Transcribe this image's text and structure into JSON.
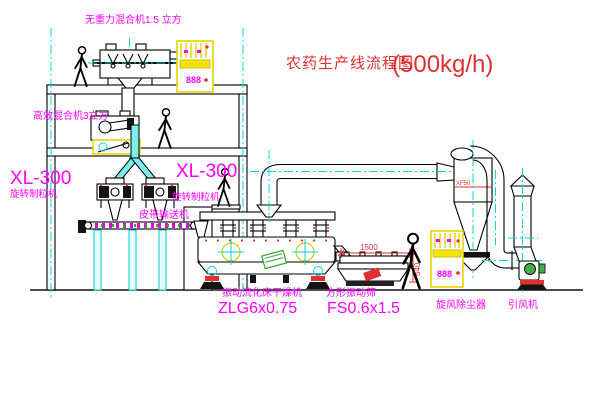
{
  "title": {
    "name": "农药生产线流程图",
    "capacity": "(500kg/h)"
  },
  "labels": {
    "gravity_mixer": "无重力混合机1.5 立方",
    "high_eff_mixer": "高效混合机3立方",
    "granulator1_model": "XL-300",
    "granulator1_name": "旋转制粒机",
    "granulator2_model": "XL-300",
    "granulator2_name": "旋转制粒机",
    "belt_conveyor": "皮带输送机",
    "fluid_bed_dryer": "振动流化床干燥机",
    "fluid_bed_dryer_model": "ZLG6x0.75",
    "square_sieve": "方形振动筛",
    "square_sieve_model": "FS0.6x1.5",
    "cyclone": "旋风除尘器",
    "fan": "引风机"
  },
  "annotations": {
    "cyclone_tag": "XF50",
    "sieve_width_dim": "1500",
    "sieve_height_dim": "540",
    "cabinet1_display": "888",
    "cabinet2_display": "888"
  },
  "colors": {
    "outline": "#000000",
    "centerline": "#00d8d8",
    "label": "#ff00ff",
    "title": "#e03030",
    "cabinet": "#f2e400",
    "dimension": "#e03030",
    "motor_green": "#45b045"
  }
}
